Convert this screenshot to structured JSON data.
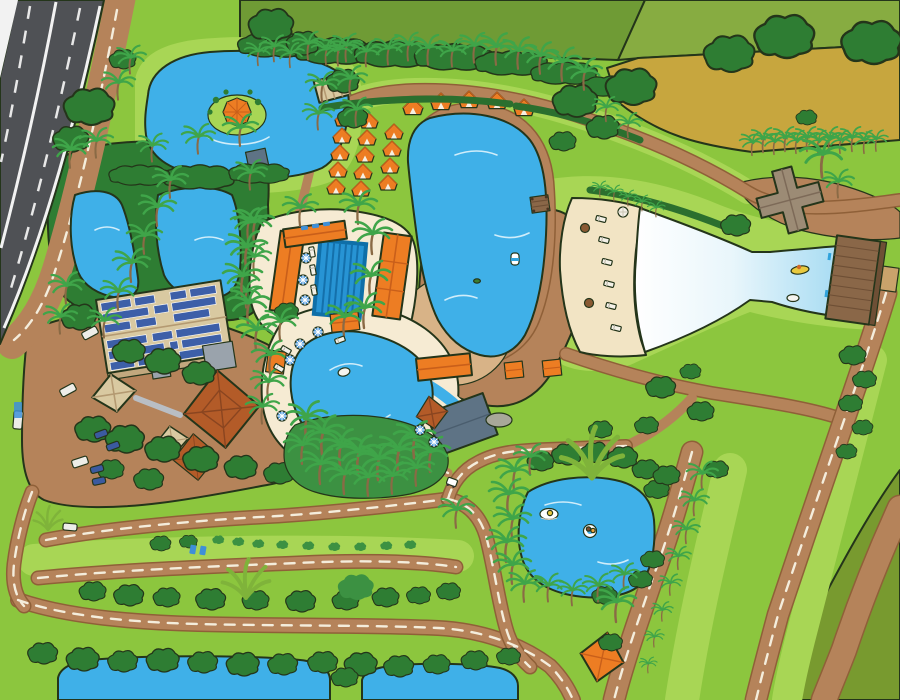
{
  "palette": {
    "grass": "#8CC63E",
    "grassLight": "#A8D655",
    "fieldOlive": "#6F9B35",
    "fieldOliveLight": "#87AC41",
    "fieldMustard": "#C7A63E",
    "fieldCorner": "#789A2F",
    "forest": "#2E7D33",
    "bush": "#3C9142",
    "hedge": "#2B6F2E",
    "palmLeaf": "#3FA549",
    "palmTrunk": "#8A6A45",
    "water": "#3FB0E8",
    "waveShallow": "#FFFFFF",
    "waveDeep": "#A0D9F2",
    "sand": "#F2E4C4",
    "deck": "#F6EBD3",
    "lakeBeach": "#D8B387",
    "dirt": "#B5835A",
    "dirtEdge": "#8F6038",
    "asphalt": "#4F5155",
    "roadLine": "#F2F2F2",
    "orange": "#ED7D23",
    "orangeDark": "#C95F1A",
    "roofRust": "#B35B28",
    "roofTan": "#D9C9A1",
    "roofSlate": "#5E7385",
    "solarPanel": "#3D5FA8",
    "pier": "#8A6748",
    "pierDark": "#6E4F35",
    "taupe": "#9C8B75",
    "umbrellaBlue": "#3E8FD8",
    "carBlue": "#3B5AA0",
    "carWhite": "#EDEDE8",
    "kayakYellow": "#E8C93E",
    "outline": "#24351A"
  },
  "features": {
    "roads": {
      "highway_lanes": 2,
      "dashed_dirt_roads": 10,
      "plain_dirt_paths": 4
    },
    "water_bodies": [
      "island-lake",
      "west-pond",
      "east-pond",
      "boating-lake",
      "wave-pool",
      "paddle-pond",
      "south-pond-west",
      "south-pond-east"
    ],
    "pools": [
      "lap-pool",
      "lagoon-pool",
      "lazy-river"
    ],
    "buildings": [
      "entrance-hut",
      "solar-roof-hall",
      "pond-side-cabin",
      "lakeside-dock",
      "orange-lodge-north",
      "orange-lodge-west",
      "orange-lodge-east",
      "pool-pavilion",
      "garden-pavilion",
      "rust-pagoda",
      "rust-pagoda-annex",
      "shade-canopy-west",
      "shade-canopy-south",
      "slate-roof-building",
      "rust-tower",
      "beach-lodge",
      "cross-building",
      "wave-pier",
      "orange-pyramid"
    ],
    "counts": {
      "cabanas_grid": 14,
      "cabanas_row": 5,
      "vehicles": 9,
      "paddle_boats": 2,
      "island_umbrellas": 1,
      "beach_tables": 2,
      "beach_loungers": 6
    }
  }
}
